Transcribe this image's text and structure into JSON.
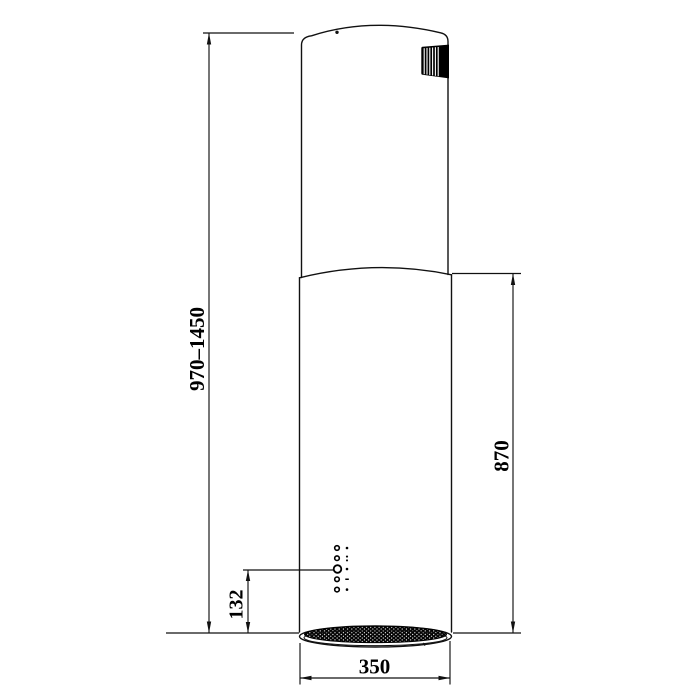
{
  "drawing": {
    "kind": "technical-dimension-drawing",
    "subject": "cylindrical-island-range-hood",
    "colors": {
      "background": "#ffffff",
      "line": "#111111",
      "fill_black": "#000000"
    },
    "dimensions": {
      "overall_height": {
        "label": "970–1450",
        "orientation": "vertical",
        "side": "left"
      },
      "body_height": {
        "label": "870",
        "orientation": "vertical",
        "side": "right"
      },
      "controls_offset": {
        "label": "132",
        "orientation": "vertical",
        "side": "left-lower"
      },
      "diameter": {
        "label": "350",
        "orientation": "horizontal",
        "side": "bottom"
      }
    },
    "features": {
      "exhaust_duct_icon": "corrugated-flex-duct",
      "control_panel": "five-round-buttons-with-indicator-dots",
      "base": "perforated-grease-filter-ellipse"
    }
  }
}
